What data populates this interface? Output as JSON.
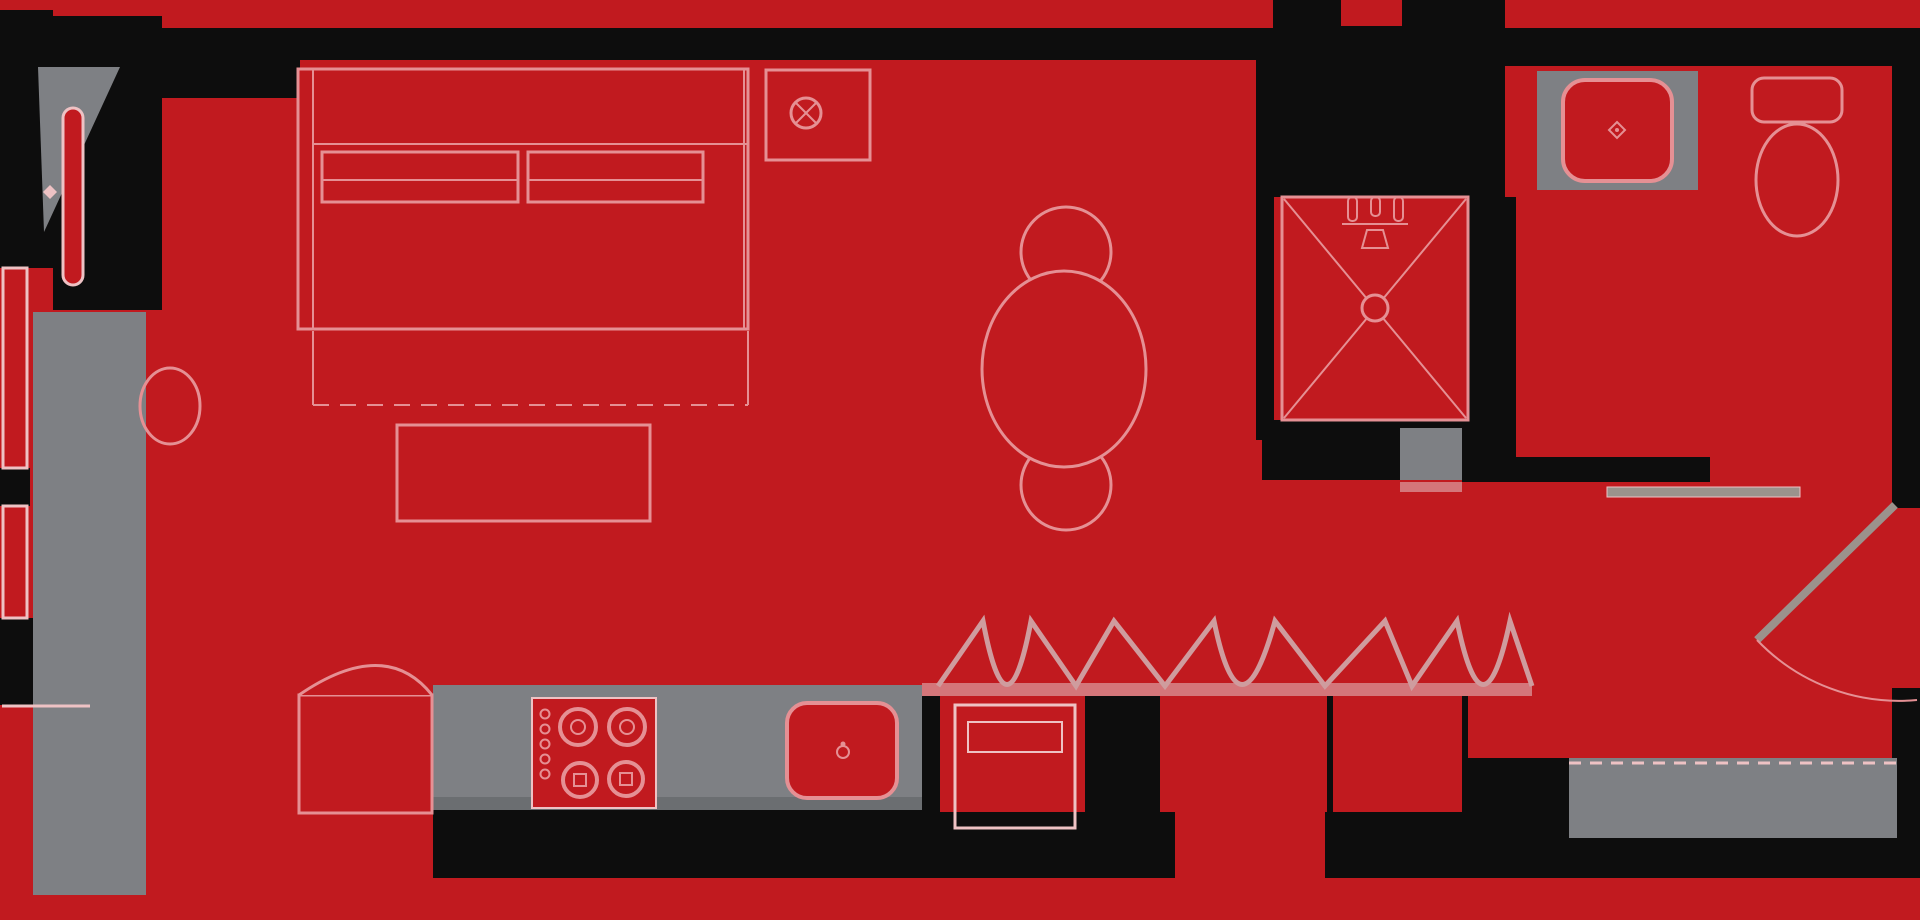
{
  "meta": {
    "kind": "architectural-floor-plan",
    "description": "Studio apartment floor plan, red floor with black walls and gray cabinetry",
    "width": 1920,
    "height": 920
  },
  "rooms": [
    "sleeping-area",
    "dining-area",
    "kitchen",
    "closet-wall",
    "shower-room",
    "bathroom",
    "entry-hall"
  ],
  "colors": {
    "red": "#c11a1f",
    "black": "#0d0d0d",
    "gray": "#7e8084",
    "grayDark": "#6b6e71",
    "pink": "#e59094",
    "pinkSoft": "#eec2c4",
    "band": "#d4767a",
    "zig": "#cf9c9e",
    "leaf": "#9b928c"
  },
  "shapes": [
    {
      "n": "floor",
      "k": "rect",
      "x": 0,
      "y": 0,
      "w": 1920,
      "h": 920,
      "f": "red"
    },
    {
      "n": "wall-top",
      "k": "rect",
      "x": 12,
      "y": 28,
      "w": 1896,
      "h": 32,
      "f": "black"
    },
    {
      "n": "wall-top-bathroom",
      "k": "rect",
      "x": 1505,
      "y": 28,
      "w": 387,
      "h": 38,
      "f": "black"
    },
    {
      "n": "wall-left-upper",
      "k": "rect",
      "x": 0,
      "y": 10,
      "w": 53,
      "h": 258,
      "f": "black"
    },
    {
      "n": "wall-entry-nook",
      "k": "rect",
      "x": 53,
      "y": 16,
      "w": 109,
      "h": 294,
      "f": "black"
    },
    {
      "n": "wall-bed-head-block",
      "k": "rect",
      "x": 162,
      "y": 28,
      "w": 138,
      "h": 70,
      "f": "black"
    },
    {
      "n": "wall-shower-left",
      "k": "rect",
      "x": 1256,
      "y": 37,
      "w": 18,
      "h": 403,
      "f": "black"
    },
    {
      "n": "wall-shower-top-mass",
      "k": "rect",
      "x": 1273,
      "y": 0,
      "w": 232,
      "h": 197,
      "f": "black"
    },
    {
      "n": "wall-top-notch",
      "k": "rect",
      "x": 1341,
      "y": 0,
      "w": 61,
      "h": 26,
      "f": "red"
    },
    {
      "n": "wall-shower-right",
      "k": "rect",
      "x": 1468,
      "y": 197,
      "w": 48,
      "h": 260,
      "f": "black"
    },
    {
      "n": "wall-shower-bottom",
      "k": "rect",
      "x": 1262,
      "y": 420,
      "w": 206,
      "h": 60,
      "f": "black"
    },
    {
      "n": "wall-bathroom-bottom",
      "k": "rect",
      "x": 1462,
      "y": 457,
      "w": 248,
      "h": 25,
      "f": "black"
    },
    {
      "n": "wall-right-upper",
      "k": "rect",
      "x": 1892,
      "y": 28,
      "w": 28,
      "h": 480,
      "f": "black"
    },
    {
      "n": "wall-right-lower",
      "k": "rect",
      "x": 1892,
      "y": 690,
      "w": 28,
      "h": 90,
      "f": "black"
    },
    {
      "n": "wall-window-mullion-upper",
      "k": "rect",
      "x": 0,
      "y": 468,
      "w": 30,
      "h": 38,
      "f": "black"
    },
    {
      "n": "wall-window-mullion-lower",
      "k": "rect",
      "x": 0,
      "y": 618,
      "w": 33,
      "h": 87,
      "f": "black"
    },
    {
      "n": "wall-kitchen-bottom",
      "k": "rect",
      "x": 433,
      "y": 810,
      "w": 502,
      "h": 68,
      "f": "black"
    },
    {
      "n": "wall-bottom-right-block",
      "k": "rect",
      "x": 935,
      "y": 688,
      "w": 985,
      "h": 190,
      "f": "black"
    },
    {
      "n": "wall-corner-nub",
      "k": "rect",
      "x": 53,
      "y": 900,
      "w": 118,
      "h": 20,
      "f": "black"
    },
    {
      "n": "wall-kitchen-divider",
      "k": "rect",
      "x": 922,
      "y": 683,
      "w": 13,
      "h": 195,
      "f": "black"
    },
    {
      "n": "closet-cell-1",
      "k": "rect",
      "x": 940,
      "y": 692,
      "w": 145,
      "h": 120,
      "f": "red"
    },
    {
      "n": "closet-cell-2",
      "k": "rect",
      "x": 1160,
      "y": 692,
      "w": 167,
      "h": 120,
      "f": "red"
    },
    {
      "n": "closet-cell-3",
      "k": "rect",
      "x": 1333,
      "y": 692,
      "w": 129,
      "h": 120,
      "f": "red"
    },
    {
      "n": "closet-cell-4",
      "k": "rect",
      "x": 1175,
      "y": 812,
      "w": 150,
      "h": 108,
      "f": "red"
    },
    {
      "n": "exterior-margin-bottom",
      "k": "rect",
      "x": 0,
      "y": 878,
      "w": 1920,
      "h": 42,
      "f": "red"
    },
    {
      "n": "entry-floor",
      "k": "rect",
      "x": 1468,
      "y": 482,
      "w": 424,
      "h": 276,
      "f": "red"
    },
    {
      "n": "wardrobe-left",
      "k": "rect",
      "x": 33,
      "y": 312,
      "w": 113,
      "h": 583,
      "f": "gray"
    },
    {
      "n": "kitchen-counter",
      "k": "rect",
      "x": 433,
      "y": 685,
      "w": 489,
      "h": 125,
      "f": "gray"
    },
    {
      "n": "kitchen-counter-edge",
      "k": "rect",
      "x": 433,
      "y": 797,
      "w": 489,
      "h": 13,
      "f": "grayDark"
    },
    {
      "n": "vanity-counter",
      "k": "rect",
      "x": 1537,
      "y": 71,
      "w": 161,
      "h": 119,
      "f": "gray"
    },
    {
      "n": "shower-step",
      "k": "rect",
      "x": 1400,
      "y": 428,
      "w": 62,
      "h": 52,
      "f": "gray"
    },
    {
      "n": "nook-triangle-panel",
      "k": "polygon",
      "pts": "38,67 120,67 44,232",
      "f": "gray"
    },
    {
      "n": "entry-mat",
      "k": "rect",
      "x": 1569,
      "y": 758,
      "w": 328,
      "h": 80,
      "f": "gray"
    },
    {
      "n": "entry-mat-dashed-line",
      "k": "line",
      "x1": 1569,
      "y1": 763,
      "x2": 1897,
      "y2": 763,
      "s": "pinkSoft",
      "sw": 3,
      "da": "12,9"
    },
    {
      "n": "window-strip-upper",
      "k": "rect",
      "x": 3,
      "y": 268,
      "w": 24,
      "h": 200,
      "f": "red",
      "s": "pinkSoft",
      "sw": 3
    },
    {
      "n": "window-strip-lower",
      "k": "rect",
      "x": 3,
      "y": 506,
      "w": 24,
      "h": 112,
      "f": "red",
      "s": "pinkSoft",
      "sw": 3
    },
    {
      "n": "closet-baseline-band",
      "k": "rect",
      "x": 922,
      "y": 683,
      "w": 610,
      "h": 13,
      "f": "band"
    },
    {
      "n": "hall-doorway-band",
      "k": "rect",
      "x": 1400,
      "y": 482,
      "w": 62,
      "h": 10,
      "f": "band"
    },
    {
      "n": "nook-door-leaf",
      "k": "rect",
      "x": 63,
      "y": 108,
      "w": 20,
      "h": 177,
      "rx": 10,
      "f": "red",
      "s": "pinkSoft",
      "sw": 3
    },
    {
      "n": "nook-door-knob",
      "k": "path",
      "d": "M50,185 l7,7 l-7,7 l-7,-7 z",
      "f": "pinkSoft"
    },
    {
      "n": "stool",
      "k": "ellipse",
      "cx": 170,
      "cy": 406,
      "rx": 30,
      "ry": 38,
      "f": "none",
      "s": "pink",
      "sw": 3
    },
    {
      "n": "bed-frame",
      "k": "rect",
      "x": 298,
      "y": 69,
      "w": 450,
      "h": 260,
      "f": "red",
      "s": "pink",
      "sw": 3
    },
    {
      "n": "bed-headboard-line",
      "k": "line",
      "x1": 313,
      "y1": 69,
      "x2": 313,
      "y2": 329,
      "s": "pink",
      "sw": 2
    },
    {
      "n": "bed-inner-right-line",
      "k": "line",
      "x1": 744,
      "y1": 69,
      "x2": 744,
      "y2": 329,
      "s": "pink",
      "sw": 2
    },
    {
      "n": "bed-blanket-line",
      "k": "line",
      "x1": 313,
      "y1": 144,
      "x2": 748,
      "y2": 144,
      "s": "pink",
      "sw": 2
    },
    {
      "n": "pillow-left",
      "k": "rect",
      "x": 322,
      "y": 152,
      "w": 196,
      "h": 50,
      "f": "red",
      "s": "pink",
      "sw": 3
    },
    {
      "n": "pillow-left-crease",
      "k": "line",
      "x1": 322,
      "y1": 180,
      "x2": 518,
      "y2": 180,
      "s": "pink",
      "sw": 2
    },
    {
      "n": "pillow-right",
      "k": "rect",
      "x": 528,
      "y": 152,
      "w": 175,
      "h": 50,
      "f": "red",
      "s": "pink",
      "sw": 3
    },
    {
      "n": "pillow-right-crease",
      "k": "line",
      "x1": 528,
      "y1": 180,
      "x2": 703,
      "y2": 180,
      "s": "pink",
      "sw": 2
    },
    {
      "n": "bed-foot-left-line",
      "k": "line",
      "x1": 313,
      "y1": 331,
      "x2": 313,
      "y2": 405,
      "s": "pink",
      "sw": 2
    },
    {
      "n": "bed-foot-right-line",
      "k": "line",
      "x1": 748,
      "y1": 331,
      "x2": 748,
      "y2": 405,
      "s": "pink",
      "sw": 2
    },
    {
      "n": "bed-foot-dashed-line",
      "k": "line",
      "x1": 313,
      "y1": 405,
      "x2": 748,
      "y2": 405,
      "s": "pink",
      "sw": 2,
      "da": "16,11"
    },
    {
      "n": "bench",
      "k": "rect",
      "x": 397,
      "y": 425,
      "w": 253,
      "h": 96,
      "f": "red",
      "s": "pink",
      "sw": 3
    },
    {
      "n": "nightstand",
      "k": "rect",
      "x": 766,
      "y": 70,
      "w": 104,
      "h": 90,
      "f": "red",
      "s": "pink",
      "sw": 3
    },
    {
      "n": "lamp-symbol",
      "k": "circle",
      "cx": 806,
      "cy": 113,
      "r": 15,
      "f": "none",
      "s": "pink",
      "sw": 3
    },
    {
      "n": "lamp-symbol-x1",
      "k": "line",
      "x1": 796,
      "y1": 103,
      "x2": 816,
      "y2": 123,
      "s": "pink",
      "sw": 2
    },
    {
      "n": "lamp-symbol-x2",
      "k": "line",
      "x1": 816,
      "y1": 103,
      "x2": 796,
      "y2": 123,
      "s": "pink",
      "sw": 2
    },
    {
      "n": "dining-chair-top",
      "k": "circle",
      "cx": 1066,
      "cy": 252,
      "r": 45,
      "f": "red",
      "s": "pink",
      "sw": 3
    },
    {
      "n": "dining-chair-bottom",
      "k": "circle",
      "cx": 1066,
      "cy": 485,
      "r": 45,
      "f": "red",
      "s": "pink",
      "sw": 3
    },
    {
      "n": "dining-table",
      "k": "ellipse",
      "cx": 1064,
      "cy": 369,
      "rx": 82,
      "ry": 98,
      "f": "red",
      "s": "pink",
      "sw": 3
    },
    {
      "n": "fridge-body",
      "k": "rect",
      "x": 299,
      "y": 695,
      "w": 133,
      "h": 118,
      "f": "red",
      "s": "pink",
      "sw": 3
    },
    {
      "n": "fridge-door-arc",
      "k": "path",
      "d": "M299,695 Q385,636 432,695",
      "f": "red",
      "s": "pink",
      "sw": 3
    },
    {
      "n": "cooktop",
      "k": "rect",
      "x": 532,
      "y": 698,
      "w": 124,
      "h": 110,
      "f": "red",
      "s": "pinkSoft",
      "sw": 2
    },
    {
      "n": "burner-1",
      "k": "circle",
      "cx": 578,
      "cy": 727,
      "r": 18,
      "f": "none",
      "s": "pink",
      "sw": 4
    },
    {
      "n": "burner-1-center",
      "k": "circle",
      "cx": 578,
      "cy": 727,
      "r": 7,
      "f": "none",
      "s": "pink",
      "sw": 2
    },
    {
      "n": "burner-2",
      "k": "circle",
      "cx": 627,
      "cy": 727,
      "r": 18,
      "f": "none",
      "s": "pink",
      "sw": 4
    },
    {
      "n": "burner-2-center",
      "k": "circle",
      "cx": 627,
      "cy": 727,
      "r": 7,
      "f": "none",
      "s": "pink",
      "sw": 2
    },
    {
      "n": "burner-3",
      "k": "circle",
      "cx": 580,
      "cy": 780,
      "r": 17,
      "f": "none",
      "s": "pink",
      "sw": 4
    },
    {
      "n": "burner-3-center",
      "k": "rect",
      "x": 574,
      "y": 774,
      "w": 12,
      "h": 12,
      "f": "none",
      "s": "pink",
      "sw": 2
    },
    {
      "n": "burner-4",
      "k": "circle",
      "cx": 626,
      "cy": 779,
      "r": 17,
      "f": "none",
      "s": "pink",
      "sw": 4
    },
    {
      "n": "burner-4-center",
      "k": "rect",
      "x": 620,
      "y": 773,
      "w": 12,
      "h": 12,
      "f": "none",
      "s": "pink",
      "sw": 2
    },
    {
      "n": "cooktop-knob-1",
      "k": "circle",
      "cx": 545,
      "cy": 714,
      "r": 4.5,
      "f": "none",
      "s": "pink",
      "sw": 2
    },
    {
      "n": "cooktop-knob-2",
      "k": "circle",
      "cx": 545,
      "cy": 729,
      "r": 4.5,
      "f": "none",
      "s": "pink",
      "sw": 2
    },
    {
      "n": "cooktop-knob-3",
      "k": "circle",
      "cx": 545,
      "cy": 744,
      "r": 4.5,
      "f": "none",
      "s": "pink",
      "sw": 2
    },
    {
      "n": "cooktop-knob-4",
      "k": "circle",
      "cx": 545,
      "cy": 759,
      "r": 4.5,
      "f": "none",
      "s": "pink",
      "sw": 2
    },
    {
      "n": "cooktop-knob-5",
      "k": "circle",
      "cx": 545,
      "cy": 774,
      "r": 4.5,
      "f": "none",
      "s": "pink",
      "sw": 2
    },
    {
      "n": "kitchen-sink",
      "k": "rect",
      "x": 787,
      "y": 703,
      "w": 110,
      "h": 95,
      "rx": 20,
      "f": "red",
      "s": "pink",
      "sw": 4
    },
    {
      "n": "kitchen-faucet",
      "k": "circle",
      "cx": 843,
      "cy": 752,
      "r": 6,
      "f": "none",
      "s": "pink",
      "sw": 2
    },
    {
      "n": "kitchen-faucet-dot",
      "k": "circle",
      "cx": 843,
      "cy": 744,
      "r": 2.5,
      "f": "pink"
    },
    {
      "n": "dishwasher",
      "k": "rect",
      "x": 955,
      "y": 705,
      "w": 120,
      "h": 123,
      "f": "none",
      "s": "pinkSoft",
      "sw": 3
    },
    {
      "n": "dishwasher-panel",
      "k": "rect",
      "x": 968,
      "y": 722,
      "w": 94,
      "h": 30,
      "f": "none",
      "s": "pinkSoft",
      "sw": 2
    },
    {
      "n": "bifold-doors-zigzag",
      "k": "path",
      "d": "M938,686 L983,621 Q1007,748 1031,621 L1076,686 L1114,621 L1165,686 L1214,621 Q1240,748 1275,621 L1325,686 L1385,621 L1412,686 L1457,621 Q1483,748 1510,621 L1532,686",
      "f": "none",
      "s": "zig",
      "sw": 5
    },
    {
      "n": "shower-pan",
      "k": "rect",
      "x": 1282,
      "y": 197,
      "w": 186,
      "h": 223,
      "f": "red",
      "s": "pink",
      "sw": 3
    },
    {
      "n": "shower-x-line-1",
      "k": "line",
      "x1": 1284,
      "y1": 199,
      "x2": 1466,
      "y2": 418,
      "s": "pink",
      "sw": 2
    },
    {
      "n": "shower-x-line-2",
      "k": "line",
      "x1": 1466,
      "y1": 199,
      "x2": 1284,
      "y2": 418,
      "s": "pink",
      "sw": 2
    },
    {
      "n": "shower-drain",
      "k": "circle",
      "cx": 1375,
      "cy": 308,
      "r": 13,
      "f": "red",
      "s": "pink",
      "sw": 3
    },
    {
      "n": "shower-hanger-1",
      "k": "rect",
      "x": 1348,
      "y": 197,
      "w": 9,
      "h": 24,
      "rx": 4,
      "f": "none",
      "s": "pink",
      "sw": 2
    },
    {
      "n": "shower-hanger-2",
      "k": "rect",
      "x": 1371,
      "y": 197,
      "w": 9,
      "h": 19,
      "rx": 4,
      "f": "none",
      "s": "pink",
      "sw": 2
    },
    {
      "n": "shower-hanger-3",
      "k": "rect",
      "x": 1394,
      "y": 197,
      "w": 9,
      "h": 24,
      "rx": 4,
      "f": "none",
      "s": "pink",
      "sw": 2
    },
    {
      "n": "shower-head-bar",
      "k": "line",
      "x1": 1342,
      "y1": 224,
      "x2": 1408,
      "y2": 224,
      "s": "pink",
      "sw": 2
    },
    {
      "n": "shower-head-bell",
      "k": "path",
      "d": "M1362,248 h26 l-5,-18 h-16 z",
      "f": "red",
      "s": "pink",
      "sw": 2
    },
    {
      "n": "vanity-sink",
      "k": "rect",
      "x": 1563,
      "y": 80,
      "w": 109,
      "h": 101,
      "rx": 22,
      "f": "red",
      "s": "pink",
      "sw": 4
    },
    {
      "n": "vanity-sink-dot",
      "k": "path",
      "d": "M1617,122 l8,8 l-8,8 l-8,-8 z",
      "f": "red",
      "s": "pink",
      "sw": 2
    },
    {
      "n": "vanity-sink-dot-center",
      "k": "circle",
      "cx": 1617,
      "cy": 130,
      "r": 2,
      "f": "pink"
    },
    {
      "n": "toilet-tank",
      "k": "rect",
      "x": 1752,
      "y": 78,
      "w": 90,
      "h": 44,
      "rx": 12,
      "f": "red",
      "s": "pink",
      "sw": 3
    },
    {
      "n": "toilet-bowl",
      "k": "ellipse",
      "cx": 1797,
      "cy": 180,
      "rx": 41,
      "ry": 56,
      "f": "red",
      "s": "pink",
      "sw": 3
    },
    {
      "n": "door-threshold-bar",
      "k": "rect",
      "x": 1607,
      "y": 487,
      "w": 193,
      "h": 10,
      "f": "leaf",
      "s": "pinkSoft",
      "sw": 1
    },
    {
      "n": "entry-door-leaf",
      "k": "line",
      "x1": 1895,
      "y1": 505,
      "x2": 1757,
      "y2": 640,
      "s": "leaf",
      "sw": 8
    },
    {
      "n": "entry-door-swing-arc",
      "k": "path",
      "d": "M1757,640 A196,196 0 0 0 1917,700",
      "f": "none",
      "s": "pink",
      "sw": 2
    },
    {
      "n": "bottom-left-trim-line",
      "k": "line",
      "x1": 2,
      "y1": 706,
      "x2": 90,
      "y2": 706,
      "s": "pinkSoft",
      "sw": 3
    }
  ]
}
